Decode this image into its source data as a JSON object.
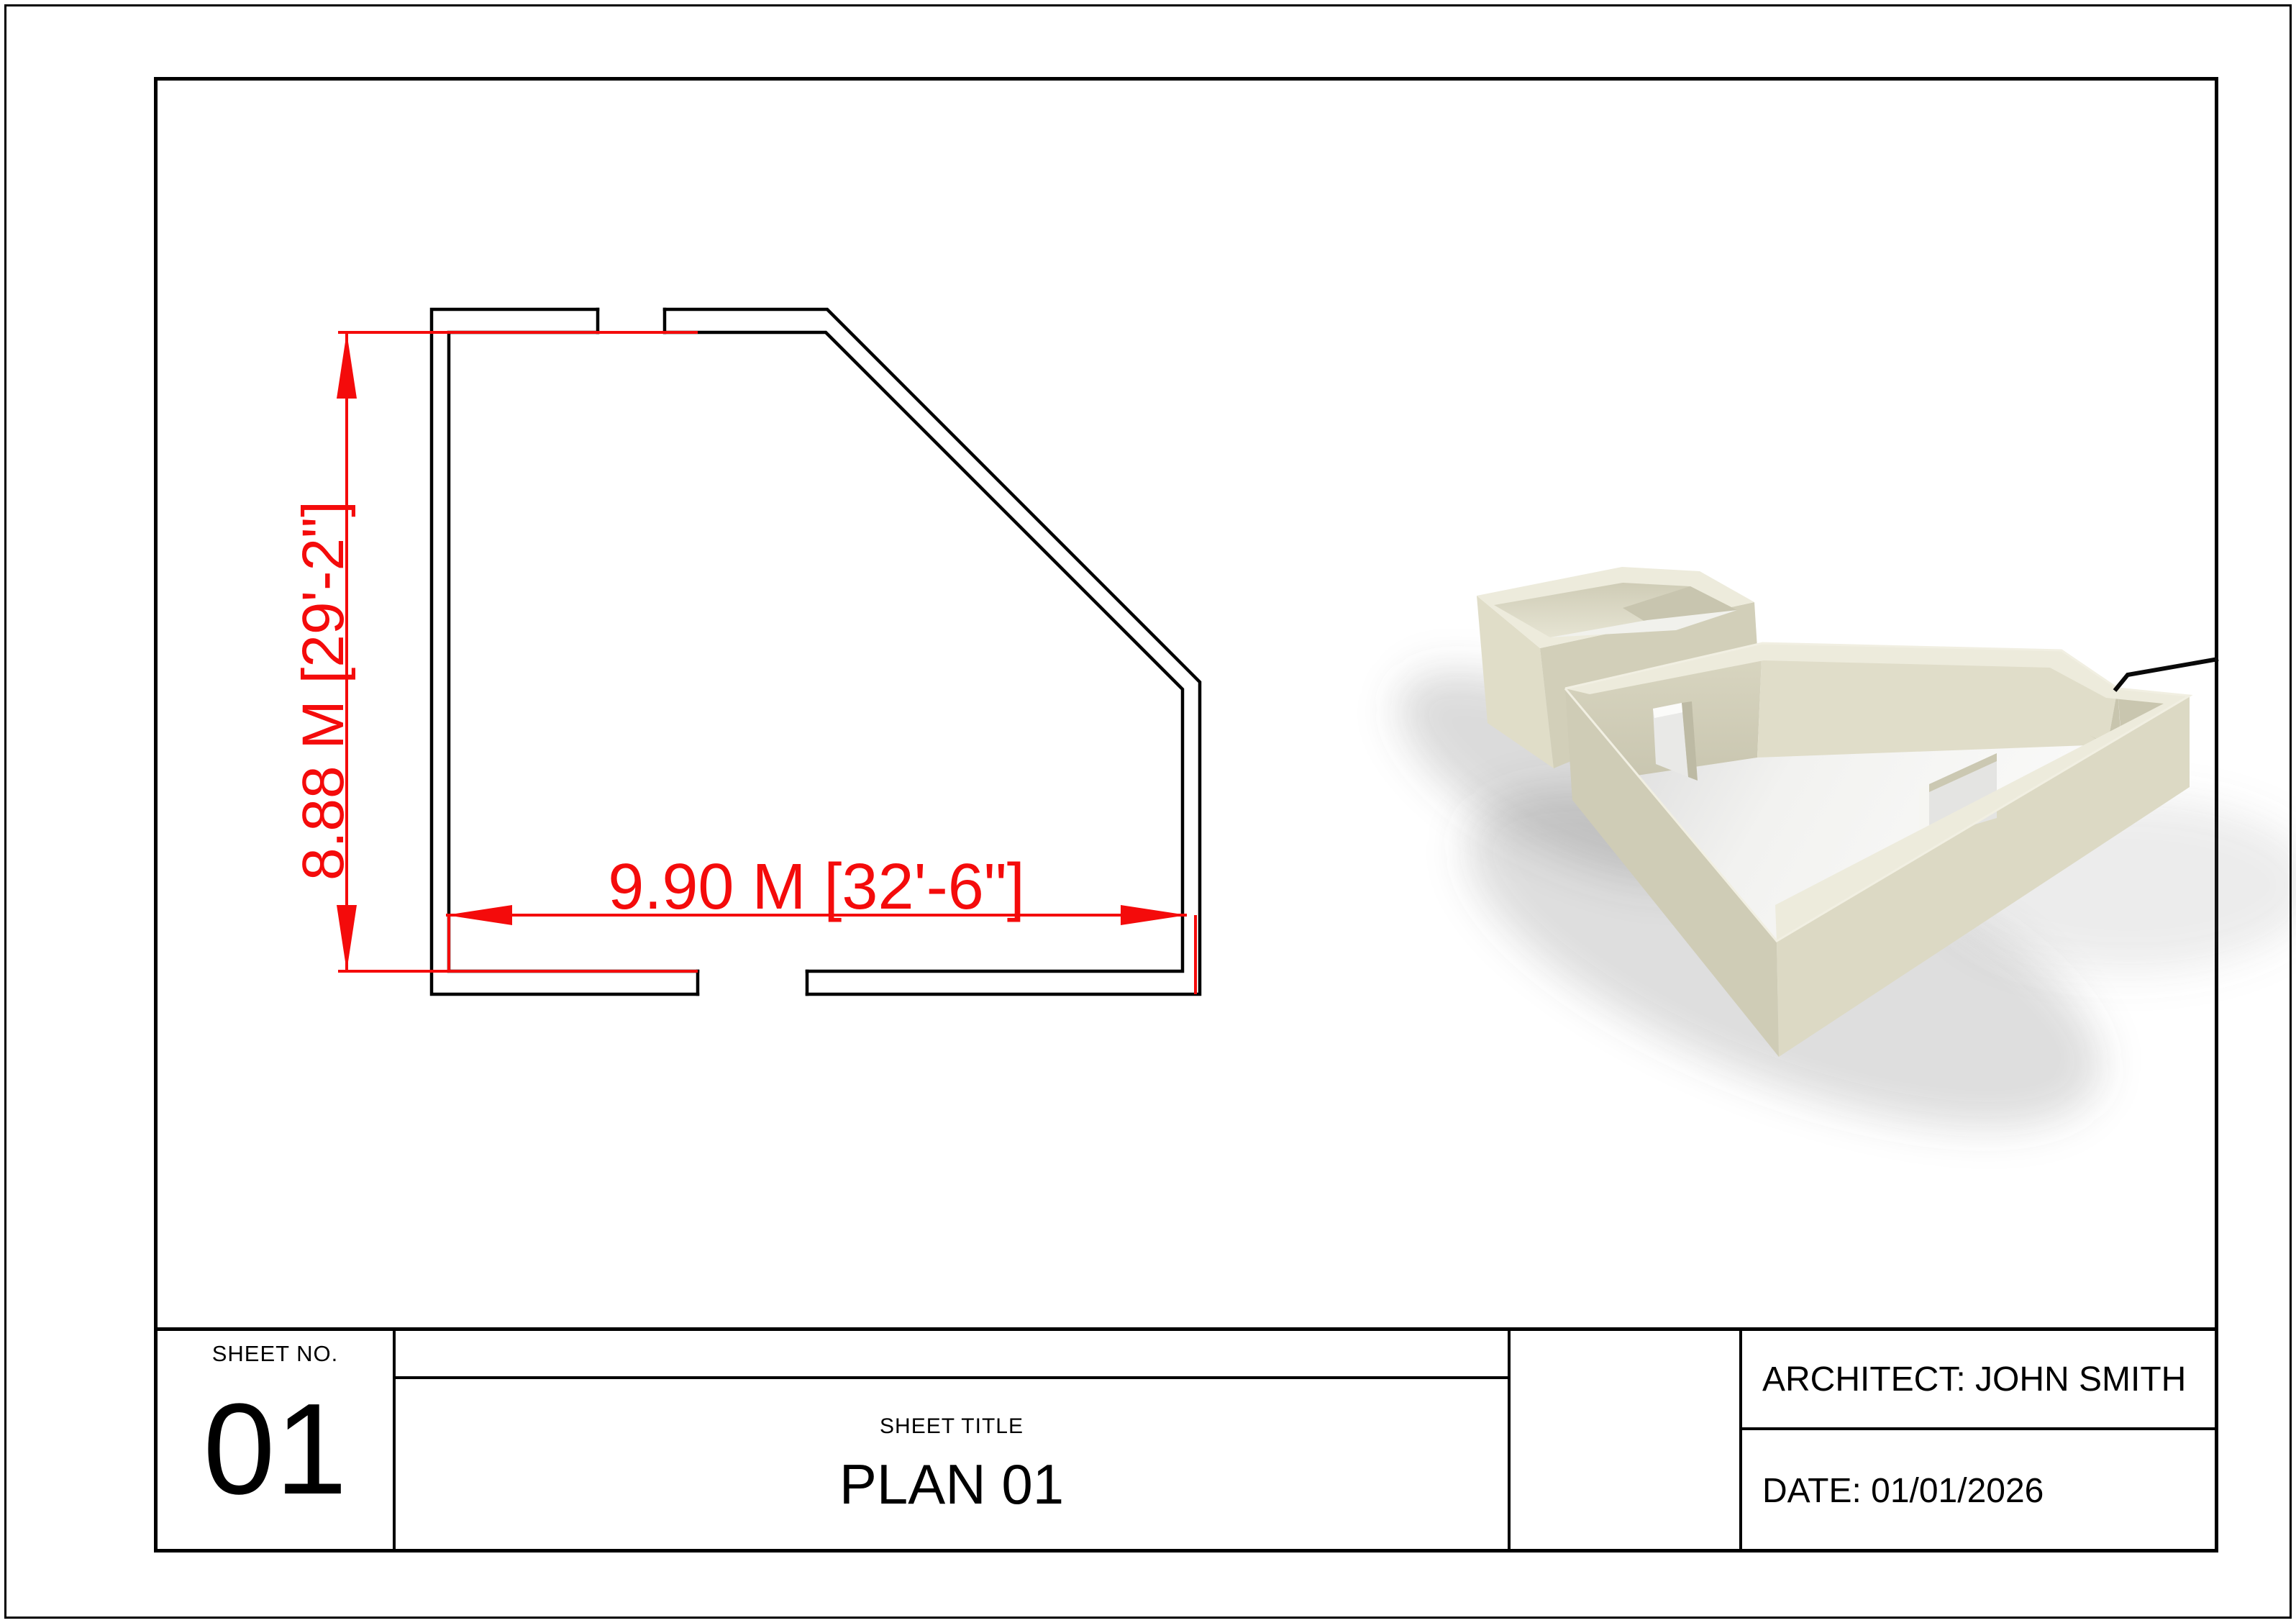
{
  "sheet": {
    "background": "#ffffff",
    "line_color": "#000000",
    "dim_color": "#f40b0b"
  },
  "plan": {
    "dim_horizontal": "9.90 M [32'-6\"]",
    "dim_vertical": "8.88 M [29'-2\"]"
  },
  "render3d": {
    "wall_top_color": "#edebdc",
    "wall_light_color": "#e0ddc9",
    "wall_medium_color": "#d5d2bc",
    "wall_dark_color": "#c9c6af",
    "floor_color": "#f6f6f4"
  },
  "titleblock": {
    "sheet_no_label": "SHEET NO.",
    "sheet_no": "01",
    "sheet_title_label": "SHEET TITLE",
    "sheet_title": "PLAN 01",
    "architect": "ARCHITECT: JOHN SMITH",
    "date": "DATE: 01/01/2026"
  }
}
